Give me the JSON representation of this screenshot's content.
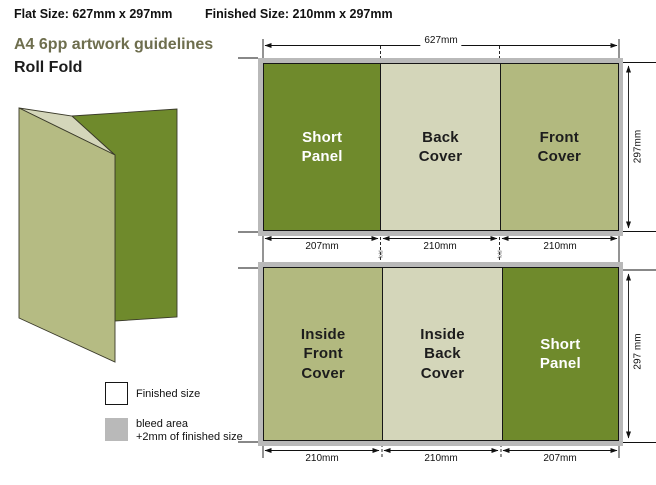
{
  "header": {
    "flat_size": "Flat Size: 627mm x 297mm",
    "finished_size": "Finished Size: 210mm x 297mm",
    "title": "A4 6pp artwork guidelines",
    "subtitle": "Roll Fold"
  },
  "sheets": {
    "outside": {
      "total_width_label": "627mm",
      "height_label": "297mm",
      "panels": [
        {
          "label": "Short\nPanel",
          "width_label": "207mm",
          "tone": "dark"
        },
        {
          "label": "Back\nCover",
          "width_label": "210mm",
          "tone": "pale"
        },
        {
          "label": "Front\nCover",
          "width_label": "210mm",
          "tone": "mid"
        }
      ]
    },
    "inside": {
      "height_label": "297 mm",
      "panels": [
        {
          "label": "Inside\nFront\nCover",
          "width_label": "210mm",
          "tone": "mid"
        },
        {
          "label": "Inside\nBack\nCover",
          "width_label": "210mm",
          "tone": "pale"
        },
        {
          "label": "Short\nPanel",
          "width_label": "207mm",
          "tone": "dark"
        }
      ]
    }
  },
  "fold_marker_label": "fold",
  "legend": {
    "finished_label": "Finished size",
    "bleed_label_line1": "bleed area",
    "bleed_label_line2": "+2mm of finished size"
  },
  "colors": {
    "dark_green": "#6f8a2c",
    "mid_green": "#b2b97f",
    "pale_green": "#d4d6ba",
    "bleed_gray": "#b9b9b9",
    "title_olive": "#6e6e4e"
  }
}
